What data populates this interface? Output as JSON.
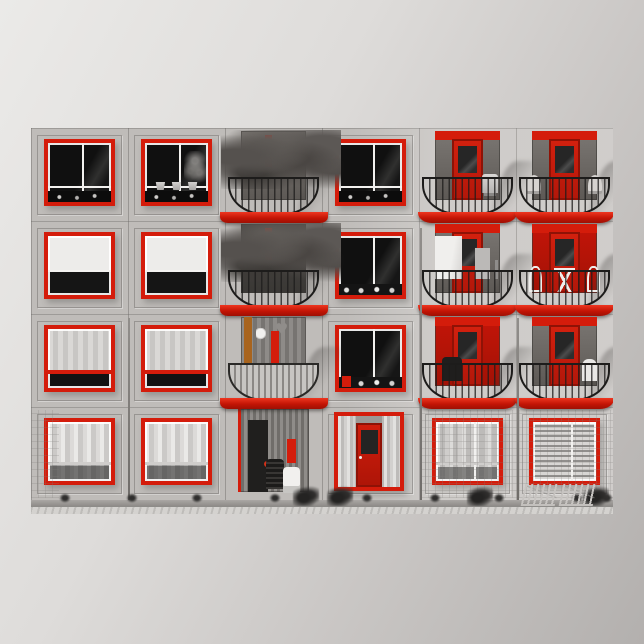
{
  "poster": {
    "subject": "Apartment building facade photographed in black and white with selective red color on window frames, doors and balcony edges",
    "style": "landscape photo print centered on a square light-gray poster"
  },
  "palette": {
    "background_top_left": "#ebeae8",
    "background_bottom_right": "#b3b0ae",
    "accent_red": "#d41c0b",
    "accent_red_bright": "#ee3620",
    "accent_red_dark": "#9e1105",
    "accent_orange": "#a8641e",
    "wall_gray": "#c9c6c3",
    "pavement_gray": "#d4d2cf",
    "glass_dark": "#161616",
    "railing_black": "#1d1c1b"
  },
  "photo": {
    "left": 31,
    "top": 128,
    "width": 582,
    "height": 386
  },
  "facade": {
    "columns": 6,
    "rows": 4,
    "window_count": 13,
    "balcony_count": 9,
    "balloon_glyph": "♥",
    "pipes": [
      {
        "x": 97,
        "top": 190,
        "bottom": 14
      },
      {
        "x": 389,
        "top": 100,
        "bottom": 14
      },
      {
        "x": 486,
        "top": 190,
        "bottom": 14
      }
    ],
    "cells": [
      {
        "name": "window-r1c1",
        "kind": "window",
        "variant": "v-dark vm-cross"
      },
      {
        "name": "window-r1c2",
        "kind": "window",
        "variant": "v-dark v-pots vm-cross"
      },
      {
        "name": "balcony-r1c3",
        "kind": "balcony",
        "variant": "v-plants"
      },
      {
        "name": "window-r1c4",
        "kind": "window",
        "variant": "v-dark vm-cross"
      },
      {
        "name": "balcony-r1c5",
        "kind": "balcony",
        "variant": "v-reddoor v-chair"
      },
      {
        "name": "balcony-r1c6",
        "kind": "balcony",
        "variant": "v-reddoor v-wicker"
      },
      {
        "name": "window-r2c1",
        "kind": "window",
        "variant": "v-whitetop"
      },
      {
        "name": "window-r2c2",
        "kind": "window",
        "variant": "v-whitetop"
      },
      {
        "name": "balcony-r2c3",
        "kind": "balcony",
        "variant": "v-plants v-dim"
      },
      {
        "name": "window-r2c4",
        "kind": "window",
        "variant": "v-dark vm-v v-silllight"
      },
      {
        "name": "balcony-r2c5",
        "kind": "balcony",
        "variant": "v-reddoor v-laundry"
      },
      {
        "name": "balcony-r2c6",
        "kind": "balcony",
        "variant": "v-redwall v-bistro"
      },
      {
        "name": "window-r3c1",
        "kind": "window",
        "variant": "v-lace"
      },
      {
        "name": "window-r3c2",
        "kind": "window",
        "variant": "v-lace"
      },
      {
        "name": "balcony-r3c3",
        "kind": "balcony",
        "variant": "v-clutter"
      },
      {
        "name": "window-r3c4",
        "kind": "window",
        "variant": "v-dark vm-v v-redsill v-silllight"
      },
      {
        "name": "balcony-r3c5",
        "kind": "balcony",
        "variant": "v-redwall v-darkchair"
      },
      {
        "name": "balcony-r3c6",
        "kind": "balcony",
        "variant": "v-reddoor v-whitechair"
      },
      {
        "name": "window-r4c1",
        "kind": "window",
        "variant": "v-drapes"
      },
      {
        "name": "window-r4c2",
        "kind": "window",
        "variant": "v-drapes"
      },
      {
        "name": "patio-r4c3",
        "kind": "patio",
        "variant": ""
      },
      {
        "name": "entry-door-r4c4",
        "kind": "entry",
        "variant": ""
      },
      {
        "name": "window-r4c5",
        "kind": "window",
        "variant": "v-curtains"
      },
      {
        "name": "window-r4c6",
        "kind": "window",
        "variant": "v-blinds"
      }
    ]
  },
  "ground": {
    "weeds_x": [
      28,
      95,
      160,
      238,
      330,
      398,
      462,
      540,
      570
    ],
    "shrubs_x": [
      262,
      296,
      436,
      552
    ],
    "loungers_x": [
      492,
      530
    ],
    "tiles": [
      {
        "left": 0,
        "top": 282,
        "width": 28,
        "height": 88
      },
      {
        "left": 390,
        "top": 282,
        "width": 192,
        "height": 88
      }
    ]
  }
}
